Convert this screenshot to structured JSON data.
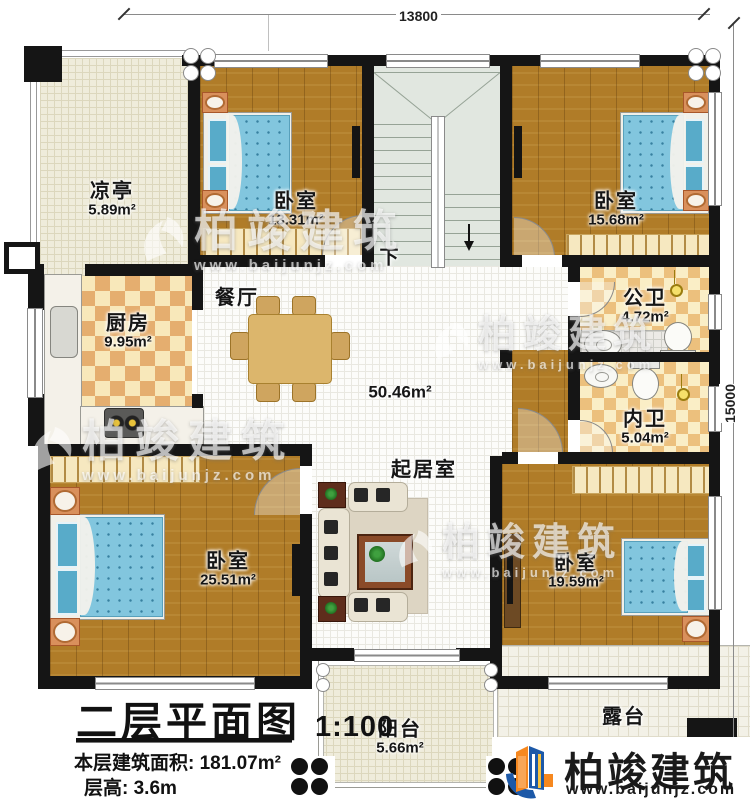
{
  "dimensions": {
    "top": "13800",
    "right": "15000"
  },
  "rooms": {
    "pavilion": {
      "name": "凉亭",
      "area": "5.89m²"
    },
    "bedroom_top_left": {
      "name": "卧室",
      "area": "13.31m²"
    },
    "bedroom_top_right": {
      "name": "卧室",
      "area": "15.68m²"
    },
    "kitchen": {
      "name": "厨房",
      "area": "9.95m²"
    },
    "dining": {
      "name": "餐厅"
    },
    "public_bath": {
      "name": "公卫",
      "area": "4.72m²"
    },
    "inner_bath": {
      "name": "内卫",
      "area": "5.04m²"
    },
    "living": {
      "name": "起居室",
      "area": "50.46m²"
    },
    "bedroom_bottom_left": {
      "name": "卧室",
      "area": "25.51m²"
    },
    "bedroom_bottom_right": {
      "name": "卧室",
      "area": "19.59m²"
    },
    "balcony": {
      "name": "阳台",
      "area": "5.66m²"
    },
    "terrace": {
      "name": "露台"
    }
  },
  "stairs": {
    "down_label": "下"
  },
  "title_block": {
    "title": "二层平面图",
    "scale": "1:100",
    "area_line": "本层建筑面积: 181.07m²",
    "floor_height_line": "层高: 3.6m"
  },
  "branding": {
    "watermark_brand": "柏竣建筑",
    "watermark_url": "www.baijunjz.com",
    "logo_brand": "柏竣建筑",
    "logo_url": "www.baijunjz.com"
  },
  "colors": {
    "wall": "#151515",
    "wood_floor": "#b07c28",
    "mattress_blue": "#82c6de",
    "checker_dark": "#e5ae6f",
    "checker_light": "#f8e8ba",
    "stair_floor": "#e1e7e0",
    "logo_blue": "#1d59a8",
    "logo_orange": "#f6881f",
    "accent_yellow": "#f5e06a"
  }
}
